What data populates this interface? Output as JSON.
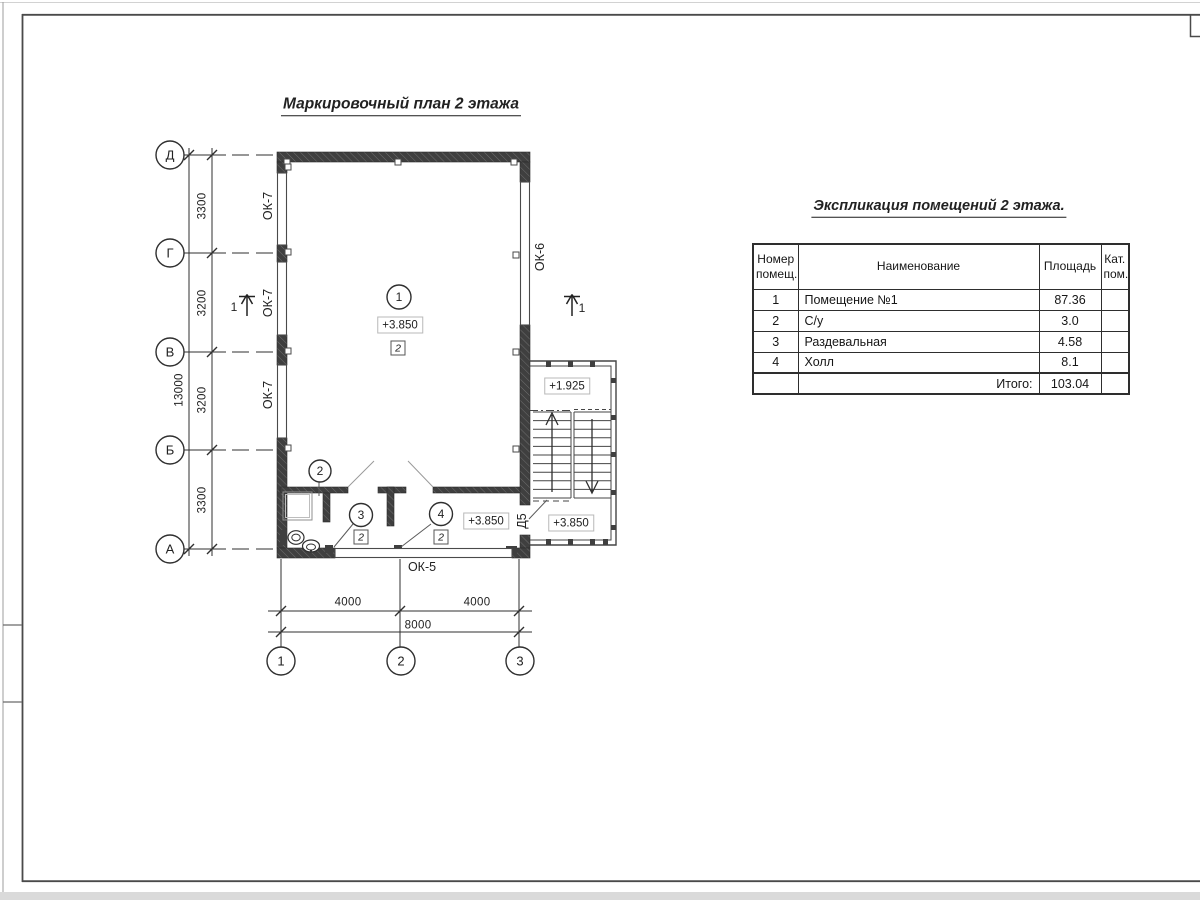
{
  "sheet": {
    "plan_title": "Маркировочный план 2 этажа",
    "table_title": "Экспликация помещений 2 этажа."
  },
  "plan": {
    "grid_rows": [
      "Д",
      "Г",
      "В",
      "Б",
      "А"
    ],
    "grid_cols": [
      "1",
      "2",
      "3"
    ],
    "dims_left": [
      "3300",
      "3200",
      "3200",
      "3300"
    ],
    "dim_left_total": "13000",
    "dims_bottom": [
      "4000",
      "4000"
    ],
    "dim_bottom_total": "8000",
    "labels": {
      "ok7": "ОК-7",
      "ok6": "ОК-6",
      "ok5": "ОК-5",
      "door": "Д5",
      "section": "1"
    },
    "room_marks": [
      "1",
      "2",
      "3",
      "4"
    ],
    "type_mark": "2",
    "elevations": {
      "room1": "+3.850",
      "hall": "+3.850",
      "stair_upper": "+1.925",
      "stair_lower": "+3.850"
    }
  },
  "table": {
    "headers": {
      "num": "Номер помещ.",
      "name": "Наименование",
      "area": "Площадь",
      "cat": "Кат. пом."
    },
    "rows": [
      {
        "num": "1",
        "name": "Помещение №1",
        "area": "87.36",
        "cat": ""
      },
      {
        "num": "2",
        "name": "С/у",
        "area": "3.0",
        "cat": ""
      },
      {
        "num": "3",
        "name": "Раздевальная",
        "area": "4.58",
        "cat": ""
      },
      {
        "num": "4",
        "name": "Холл",
        "area": "8.1",
        "cat": ""
      }
    ],
    "total_label": "Итого:",
    "total_value": "103.04"
  }
}
